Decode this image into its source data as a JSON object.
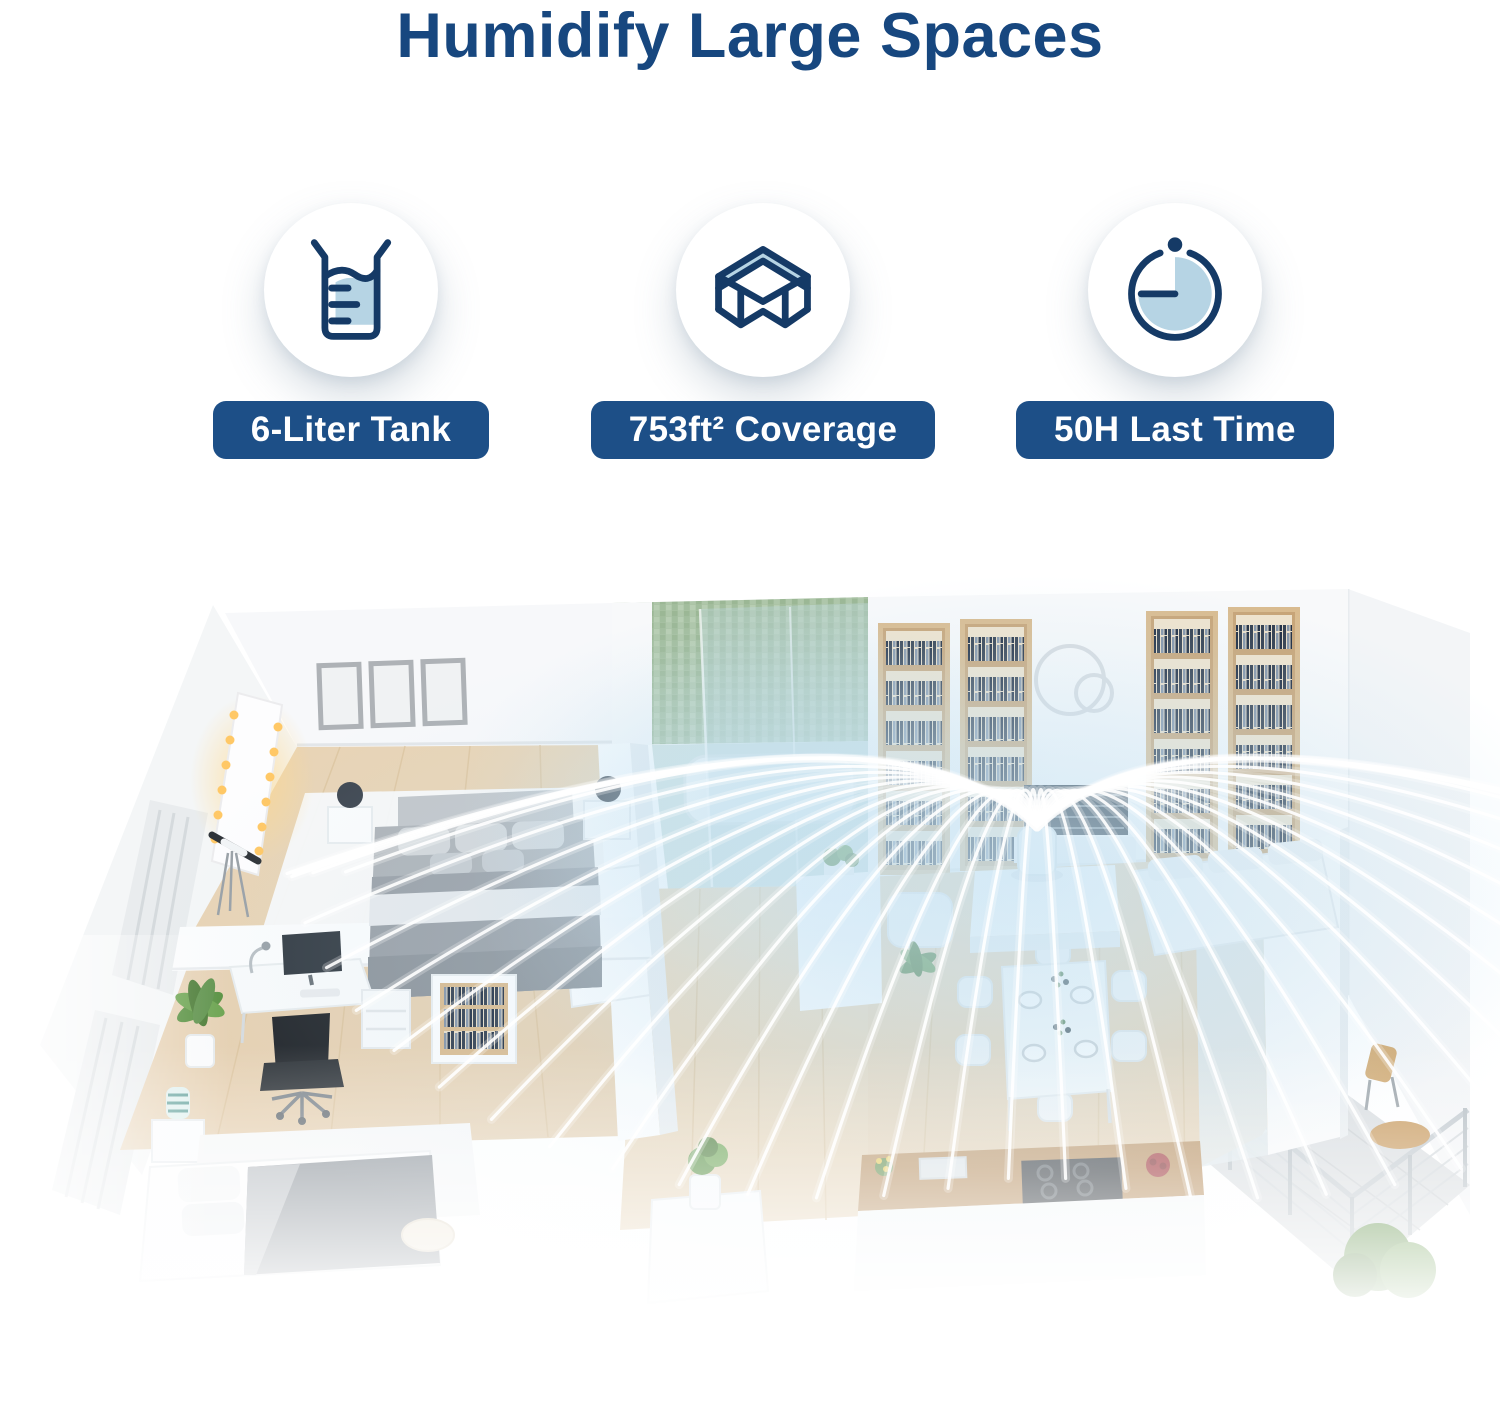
{
  "header": {
    "title": "Humidify Large Spaces"
  },
  "features": [
    {
      "icon": "beaker-tank-icon",
      "label": "6-Liter Tank"
    },
    {
      "icon": "room-coverage-icon",
      "label": "753ft² Coverage"
    },
    {
      "icon": "timer-icon",
      "label": "50H Last Time"
    }
  ],
  "colors": {
    "title_color": "#17477F",
    "badge_bg": "#1D4F87",
    "badge_text": "#FFFFFF",
    "icon_navy": "#153A66",
    "icon_lightblue": "#B6D4E4",
    "mist_white": "#FFFFFF",
    "mist_haze": "#C6E3F4",
    "wood_floor": "#E7D3B5",
    "bathroom_green": "#A9C2A4",
    "wall_white": "#F7F8FA"
  },
  "illustration": {
    "mist": {
      "origin": [
        1037,
        252
      ],
      "count": 38,
      "angle_start": 197,
      "angle_end": -17,
      "base_r": 290,
      "stretch": 460,
      "down_boost": 270,
      "y_scale": 0.62,
      "lift": 158,
      "min_drop": 0.1
    }
  }
}
